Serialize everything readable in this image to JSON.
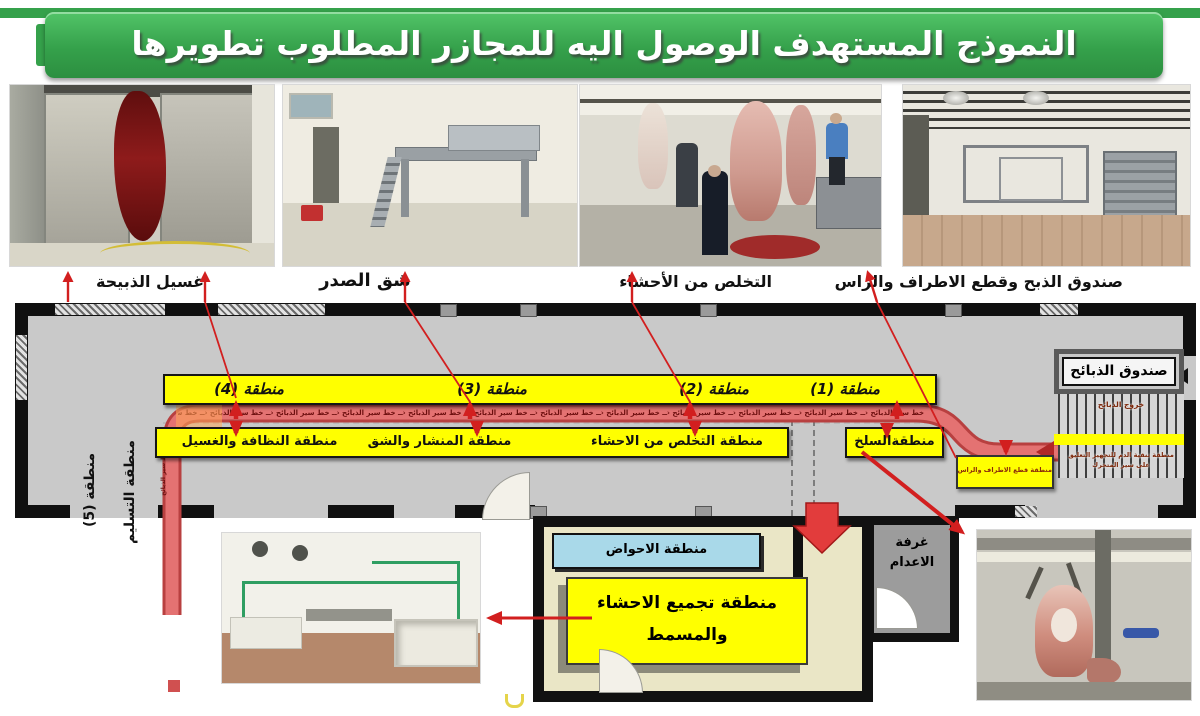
{
  "title": "النموذج المستهدف الوصول اليه للمجازر المطلوب تطويرها",
  "captions": {
    "wash": "غسيل الذبيحة",
    "chest": "شق الصدر",
    "viscera": "التخلص من الأحشاء",
    "slaughter": "صندوق الذبح وقطع الاطراف والراس"
  },
  "plan": {
    "zone1": "منطقة (1)",
    "zone2": "منطقة (2)",
    "zone3": "منطقة (3)",
    "zone4": "منطقة (4)",
    "zone5": "منطقة (5)",
    "conveyor_label": "خط سير الذبائح",
    "area_cleaning": "منطقة النظافة والغسيل",
    "area_saw": "منطقة المنشار والشق",
    "area_viscera": "منطقة التخلص من الاحشاء",
    "area_skinning": "منطقةالسلخ",
    "slaughter_box": "صندوق الذبائح",
    "exit_label": "خروج الذبائح",
    "blood_area": "منطقة تنقية الدم للتجهيز التعليق على سير المتحرك",
    "limbs_box": "منطقة قطع الاطراف والراس",
    "delivery": "منطقة التسليم",
    "basins": "منطقة الاحواض",
    "viscera_collection": "منطقة تجميع الاحشاء والمسمط",
    "condemnation": "غرفة الاعدام"
  },
  "colors": {
    "banner_green": "#35a14b",
    "zone_yellow": "#ffff00",
    "conveyor_red": "#e06a6a",
    "arrow_red": "#d21f1f",
    "room_beige": "#eae6c6",
    "basins_blue": "#a9d9e9",
    "floor_gray": "#c9c9c9"
  }
}
